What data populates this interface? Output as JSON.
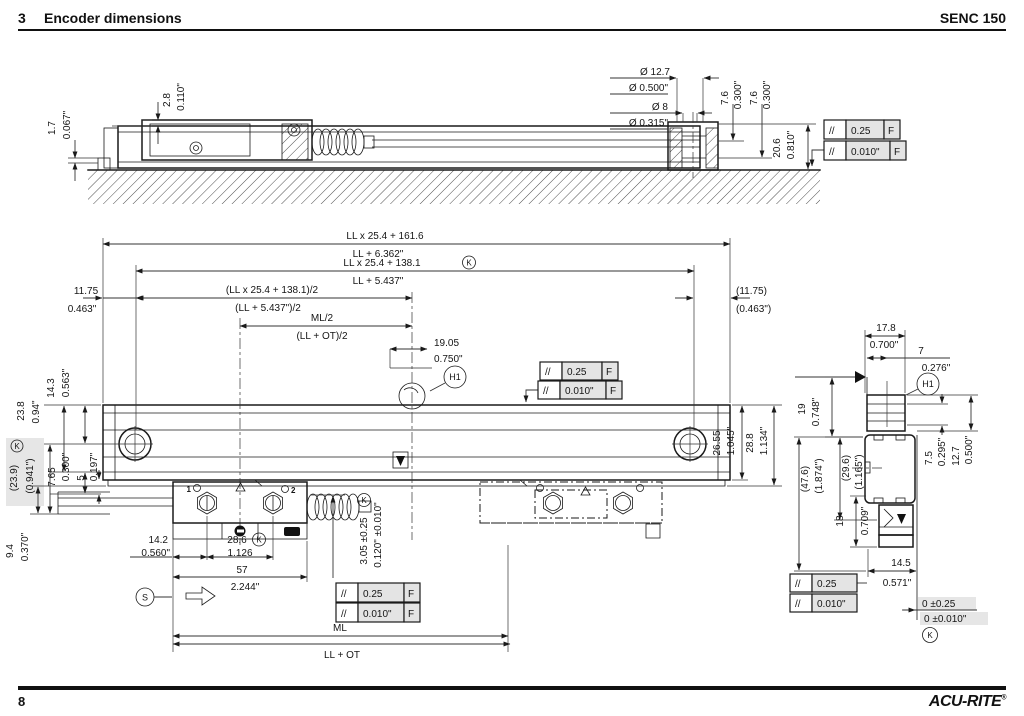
{
  "header": {
    "section_no": "3",
    "title": "Encoder dimensions",
    "model": "SENC 150"
  },
  "footer": {
    "page_number": "8",
    "brand": "ACU-RITE",
    "brand_mark": "®"
  },
  "fcf": {
    "sym": "//",
    "tol_mm": "0.25",
    "tol_in": "0.010\"",
    "datum": "F"
  },
  "refs": {
    "k": "K",
    "s": "S",
    "h1": "H1",
    "bolt1": "1",
    "bolt2": "2"
  },
  "side_view": {
    "dia1_mm": "Ø 12.7",
    "dia1_in": "Ø 0.500\"",
    "dia2_mm": "Ø 8",
    "dia2_in": "Ø 0.315\"",
    "off1_mm": "7.6",
    "off1_in": "0.300\"",
    "off2_mm": "7.6",
    "off2_in": "0.300\"",
    "h_mm": "20.6",
    "h_in": "0.810\"",
    "gap1_mm": "2.8",
    "gap1_in": "0.110\"",
    "gap2_mm": "1.7",
    "gap2_in": "0.067\""
  },
  "front_view": {
    "overall_mm": "LL x 25.4 + 161.6",
    "overall_in": "LL + 6.362\"",
    "mount_mm": "LL x 25.4 + 138.1",
    "mount_in": "LL + 5.437\"",
    "half_mount_mm": "(LL x 25.4 + 138.1)/2",
    "half_mount_in": "(LL + 5.437\")/2",
    "half_ml": "ML/2",
    "half_ll_ot": "(LL + OT)/2",
    "end_mm": "11.75",
    "end_in": "0.463\"",
    "end_ref_mm": "(11.75)",
    "end_ref_in": "(0.463\")",
    "refmark_mm": "19.05",
    "refmark_in": "0.750\"",
    "d14_3_mm": "14.3",
    "d14_3_in": "0.563\"",
    "d23_8_mm": "23.8",
    "d23_8_in": "0.94\"",
    "d23_9_mm": "(23.9)",
    "d23_9_in": "(0.941\")",
    "d7_65_mm": "7.65",
    "d7_65_in": "0.300\"",
    "d5_mm": "5",
    "d5_in": "0.197\"",
    "d9_4_mm": "9.4",
    "d9_4_in": "0.370\"",
    "d26_55_mm": "26.55",
    "d26_55_in": "1.045\"",
    "d28_8_mm": "28.8",
    "d28_8_in": "1.134\"",
    "d14_2_mm": "14.2",
    "d14_2_in": "0.560\"",
    "d28_6_mm": "28.6",
    "d28_6_in": "1.126",
    "d57_mm": "57",
    "d57_in": "2.244\"",
    "d3_05_mm": "3.05 ±0.25",
    "d3_05_in": "0.120\" ±0.010\"",
    "ml": "ML",
    "ll_ot": "LL + OT"
  },
  "section_view": {
    "w17_8_mm": "17.8",
    "w17_8_in": "0.700\"",
    "w7_mm": "7",
    "w7_in": "0.276\"",
    "h19_mm": "19",
    "h19_in": "0.748\"",
    "h7_5_mm": "7.5",
    "h7_5_in": "0.295\"",
    "h12_7_mm": "12.7",
    "h12_7_in": "0.500\"",
    "h47_6_mm": "(47.6)",
    "h47_6_in": "(1.874\")",
    "h29_6_mm": "(29.6)",
    "h29_6_in": "(1.165\")",
    "h18_mm": "18",
    "h18_in": "0.709\"",
    "w14_5_mm": "14.5",
    "w14_5_in": "0.571\"",
    "zero_mm": "0 ±0.25",
    "zero_in": "0 ±0.010\""
  }
}
